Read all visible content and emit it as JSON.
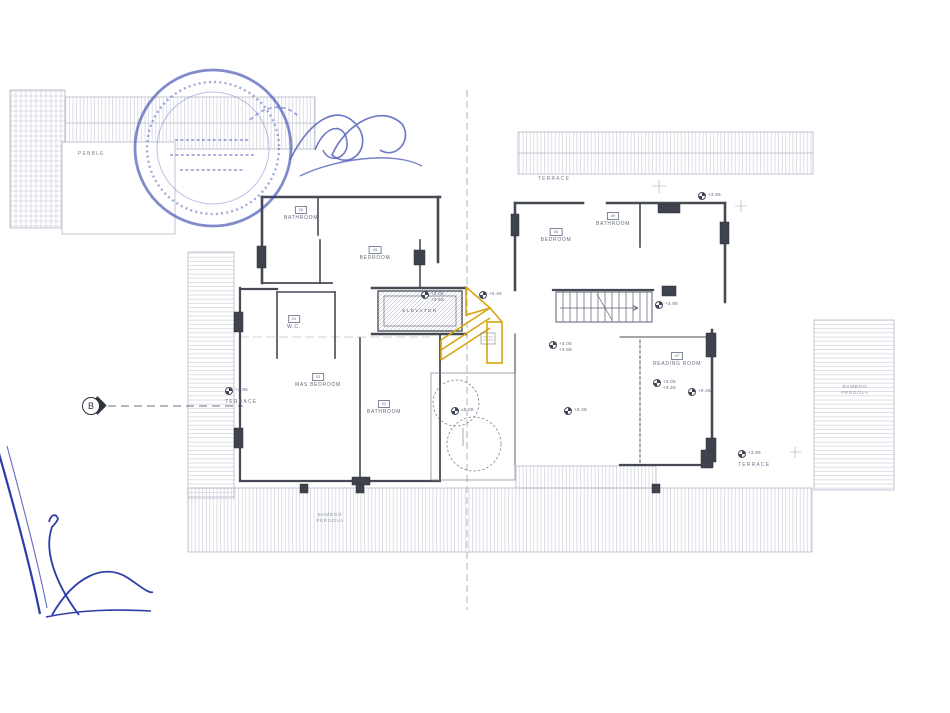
{
  "colors": {
    "ink_blue": "#2c3da8",
    "wall_gray": "#454a55",
    "hatch_gray": "#c6cad6",
    "label_gray": "#70768a",
    "highlight_orange": "#d7a50b"
  },
  "plan": {
    "section_marker": "B",
    "labels": {
      "pebble": "PEBBLE",
      "terrace_top": "TERRACE",
      "elevator": "ELEVATOR",
      "bamboo_bottom_1": "BAMBOO",
      "bamboo_bottom_2": "PERGOLA",
      "bamboo_right_1": "BAMBOO",
      "bamboo_right_2": "PERGOLA"
    },
    "rooms": [
      {
        "code": "06",
        "name": "BATHROOM",
        "x": 301,
        "y": 206
      },
      {
        "code": "05",
        "name": "BEDROOM",
        "x": 375,
        "y": 246
      },
      {
        "code": "08",
        "name": "BEDROOM",
        "x": 556,
        "y": 228
      },
      {
        "code": "09",
        "name": "BATHROOM",
        "x": 613,
        "y": 212
      },
      {
        "code": "04",
        "name": "W.C.",
        "x": 294,
        "y": 315
      },
      {
        "code": "03",
        "name": "MAS BEDROOM",
        "x": 318,
        "y": 373
      },
      {
        "code": "02",
        "name": "BATHROOM",
        "x": 384,
        "y": 400
      },
      {
        "code": "07",
        "name": "READING ROOM",
        "x": 677,
        "y": 352
      }
    ],
    "elevations": [
      {
        "x": 698,
        "y": 192,
        "lines": [
          "+3.95"
        ]
      },
      {
        "x": 655,
        "y": 301,
        "lines": [
          "+3.95"
        ]
      },
      {
        "x": 421,
        "y": 291,
        "lines": [
          "+3.05",
          "+3.65"
        ]
      },
      {
        "x": 479,
        "y": 291,
        "lines": [
          "+0.45"
        ]
      },
      {
        "x": 549,
        "y": 341,
        "lines": [
          "+3.05",
          "+3.65"
        ]
      },
      {
        "x": 451,
        "y": 407,
        "lines": [
          "±0.00"
        ]
      },
      {
        "x": 564,
        "y": 407,
        "lines": [
          "+0.45"
        ]
      },
      {
        "x": 653,
        "y": 379,
        "lines": [
          "+3.05",
          "+3.25"
        ]
      },
      {
        "x": 688,
        "y": 388,
        "lines": [
          "+0.45"
        ]
      },
      {
        "x": 738,
        "y": 450,
        "lines": [
          "+3.95"
        ],
        "sub": "TERRACE"
      },
      {
        "x": 225,
        "y": 387,
        "lines": [
          "+3.95"
        ],
        "sub": "TERRACE"
      }
    ]
  }
}
